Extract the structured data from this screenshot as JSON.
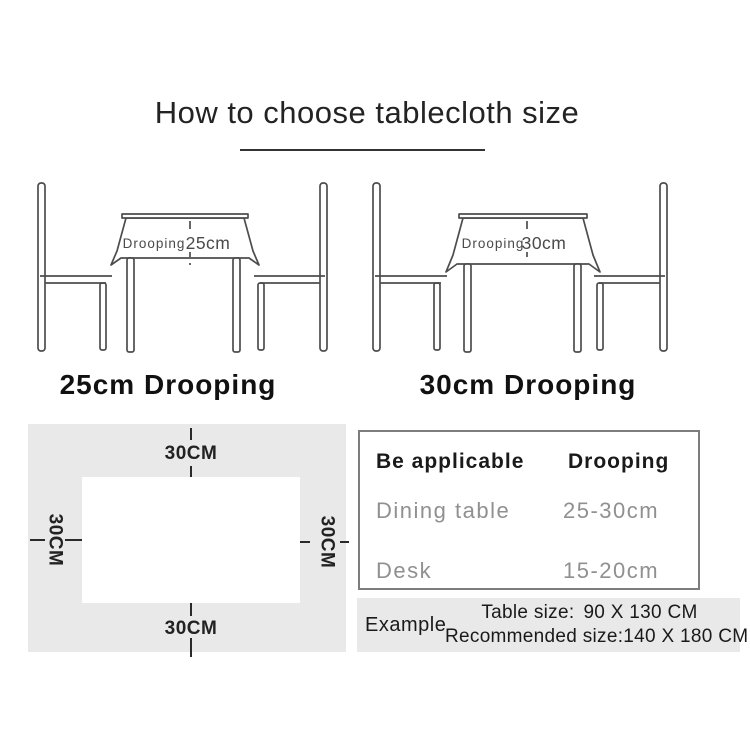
{
  "title": "How to choose tablecloth size",
  "illustrations": {
    "left": {
      "cloth_label_prefix": "Drooping",
      "cloth_label_value": "25cm",
      "caption": "25cm Drooping"
    },
    "right": {
      "cloth_label_prefix": "Drooping",
      "cloth_label_value": "30cm",
      "caption": "30cm Drooping"
    }
  },
  "size_diagram": {
    "top_label": "30CM",
    "bottom_label": "30CM",
    "left_label": "30CM",
    "right_label": "30CM"
  },
  "drooping_table": {
    "headers": [
      "Be applicable",
      "Drooping"
    ],
    "rows": [
      [
        "Dining table",
        "25-30cm"
      ],
      [
        "Desk",
        "15-20cm"
      ]
    ]
  },
  "example": {
    "label": "Example",
    "table_size_label": "Table size:",
    "table_size_value": "90 X 130 CM",
    "recommended_label": "Recommended size:",
    "recommended_value": "140 X 180 CM"
  },
  "colors": {
    "line_art_stroke": "#4d4d4d",
    "diagram_background": "#e9e9e9",
    "table_border": "#7d7d7d",
    "muted_text": "#909090",
    "dark_text": "#1a1a1a"
  }
}
